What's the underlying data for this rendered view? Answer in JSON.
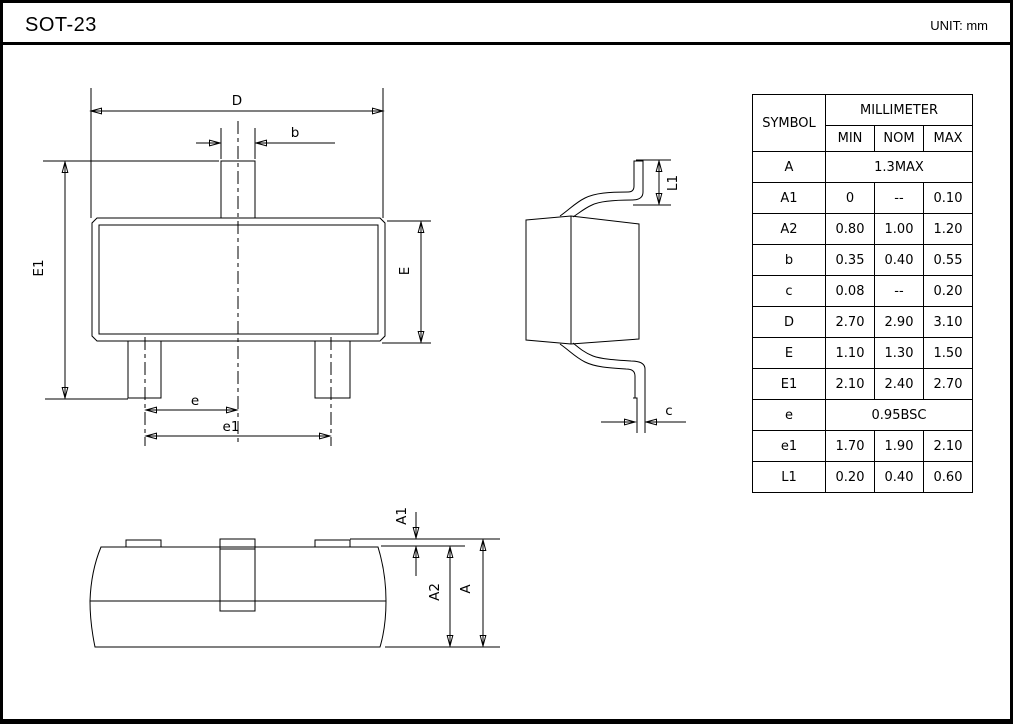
{
  "page": {
    "title": "SOT-23",
    "unit_label": "UNIT: mm"
  },
  "table": {
    "header": {
      "symbol": "SYMBOL",
      "group": "MILLIMETER",
      "min": "MIN",
      "nom": "NOM",
      "max": "MAX"
    },
    "rows": [
      {
        "symbol": "A",
        "span": "1.3MAX"
      },
      {
        "symbol": "A1",
        "min": "0",
        "nom": "--",
        "max": "0.10"
      },
      {
        "symbol": "A2",
        "min": "0.80",
        "nom": "1.00",
        "max": "1.20"
      },
      {
        "symbol": "b",
        "min": "0.35",
        "nom": "0.40",
        "max": "0.55"
      },
      {
        "symbol": "c",
        "min": "0.08",
        "nom": "--",
        "max": "0.20"
      },
      {
        "symbol": "D",
        "min": "2.70",
        "nom": "2.90",
        "max": "3.10"
      },
      {
        "symbol": "E",
        "min": "1.10",
        "nom": "1.30",
        "max": "1.50"
      },
      {
        "symbol": "E1",
        "min": "2.10",
        "nom": "2.40",
        "max": "2.70"
      },
      {
        "symbol": "e",
        "span": "0.95BSC"
      },
      {
        "symbol": "e1",
        "min": "1.70",
        "nom": "1.90",
        "max": "2.10"
      },
      {
        "symbol": "L1",
        "min": "0.20",
        "nom": "0.40",
        "max": "0.60"
      }
    ]
  },
  "labels": {
    "d": "D",
    "b": "b",
    "e1_side": "E1",
    "e_side": "E",
    "e": "e",
    "e1": "e1",
    "l1": "L1",
    "c": "c",
    "a1": "A1",
    "a2": "A2",
    "a": "A"
  }
}
